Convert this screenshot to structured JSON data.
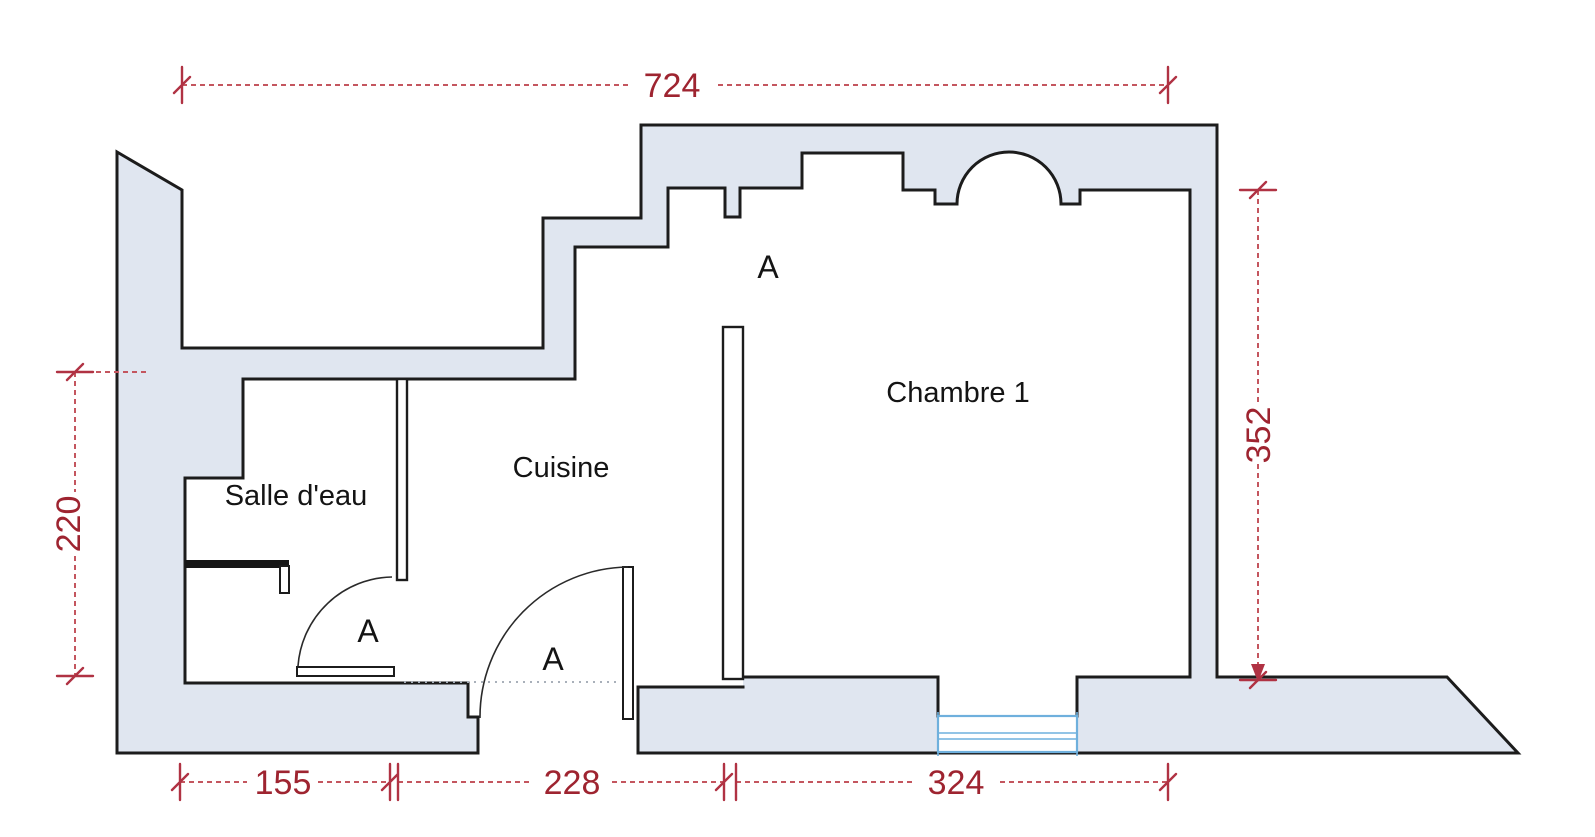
{
  "plan": {
    "type": "floor-plan-scan",
    "rooms": [
      {
        "id": "salle-deau",
        "name": "Salle d'eau"
      },
      {
        "id": "cuisine",
        "name": "Cuisine"
      },
      {
        "id": "chambre-1",
        "name": "Chambre 1"
      }
    ],
    "door_labels": [
      {
        "id": "door-salle-deau",
        "label": "A"
      },
      {
        "id": "door-entrance",
        "label": "A"
      },
      {
        "id": "door-chambre",
        "label": "A"
      }
    ],
    "dimensions": {
      "top": "724",
      "right": "352",
      "left": "220",
      "bottom_left": "155",
      "bottom_middle": "228",
      "bottom_right": "324"
    },
    "colors": {
      "wall_fill": "#e0e6f0",
      "wall_outline": "#1c1c1c",
      "dimension_text": "#9e2430",
      "dimension_line": "#c4565f",
      "dimension_tick": "#b03243",
      "window_blue": "#6fb0dd",
      "label_text": "#141414",
      "background": "#ffffff"
    }
  }
}
